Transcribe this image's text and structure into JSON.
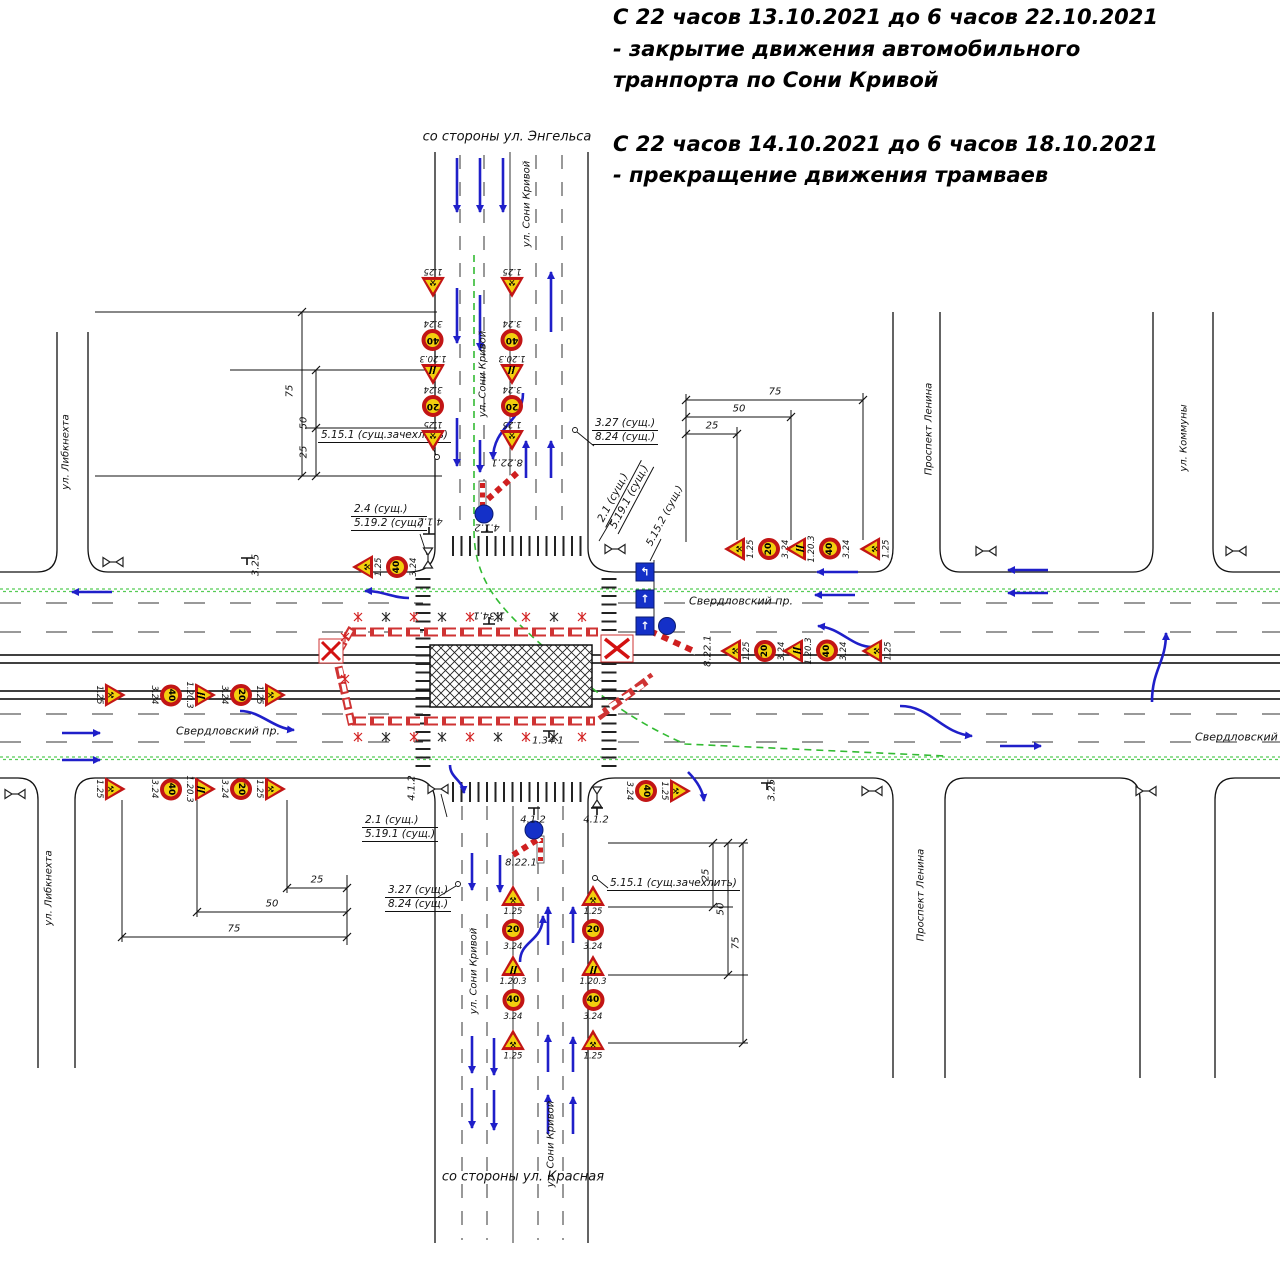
{
  "header": {
    "notice1": "С 22 часов 13.10.2021 до 6 часов 22.10.2021 - закрытие движения автомобильного транпорта по Сони Кривой",
    "notice2": "С 22 часов 14.10.2021 до 6 часов 18.10.2021 - прекращение движения трамваев"
  },
  "streets": {
    "from_engels": "со стороны ул. Энгельса",
    "from_krasnaya": "со стороны ул. Красная",
    "soni_krivoy": "ул. Сони Кривой",
    "sverdlovsky": "Свердловский пр.",
    "libknehta": "ул. Либкнехта",
    "lenina": "Проспект Ленина",
    "kommuny": "ул. Коммуны"
  },
  "codes": {
    "c1_25": "1.25",
    "c1_20_3": "1.20.3",
    "c3_24": "3.24",
    "c3_25": "3.25",
    "v40": "40",
    "v20": "20"
  },
  "annotations": {
    "a5151": "5.15.1 (сущ.зачехлить)",
    "a327": "3.27 (сущ.)",
    "a824": "8.24 (сущ.)",
    "a24": "2.4 (сущ.)",
    "a5192": "5.19.2 (сущ.)",
    "a21": "2.1 (сущ.)",
    "a5191": "5.19.1 (сущ.)",
    "a5152": "5.15.2 (сущ.)",
    "a8221": "8.22.1",
    "a412": "4.1.2",
    "a1341": "1.34.1"
  },
  "dimensions": {
    "d25": "25",
    "d50": "50",
    "d75": "75"
  },
  "glyphs": {
    "works": "⚒",
    "lane_turn": "↰",
    "lane_straight": "↑"
  },
  "colors": {
    "arrow_blue": "#1f1fc9",
    "sign_red": "#c21515",
    "sign_yellow": "#f2cf0e",
    "barrier_red": "#cf3333",
    "tram_green": "#55cc55",
    "detour_green": "#33bb33",
    "signal_blue": "#1430c8"
  }
}
